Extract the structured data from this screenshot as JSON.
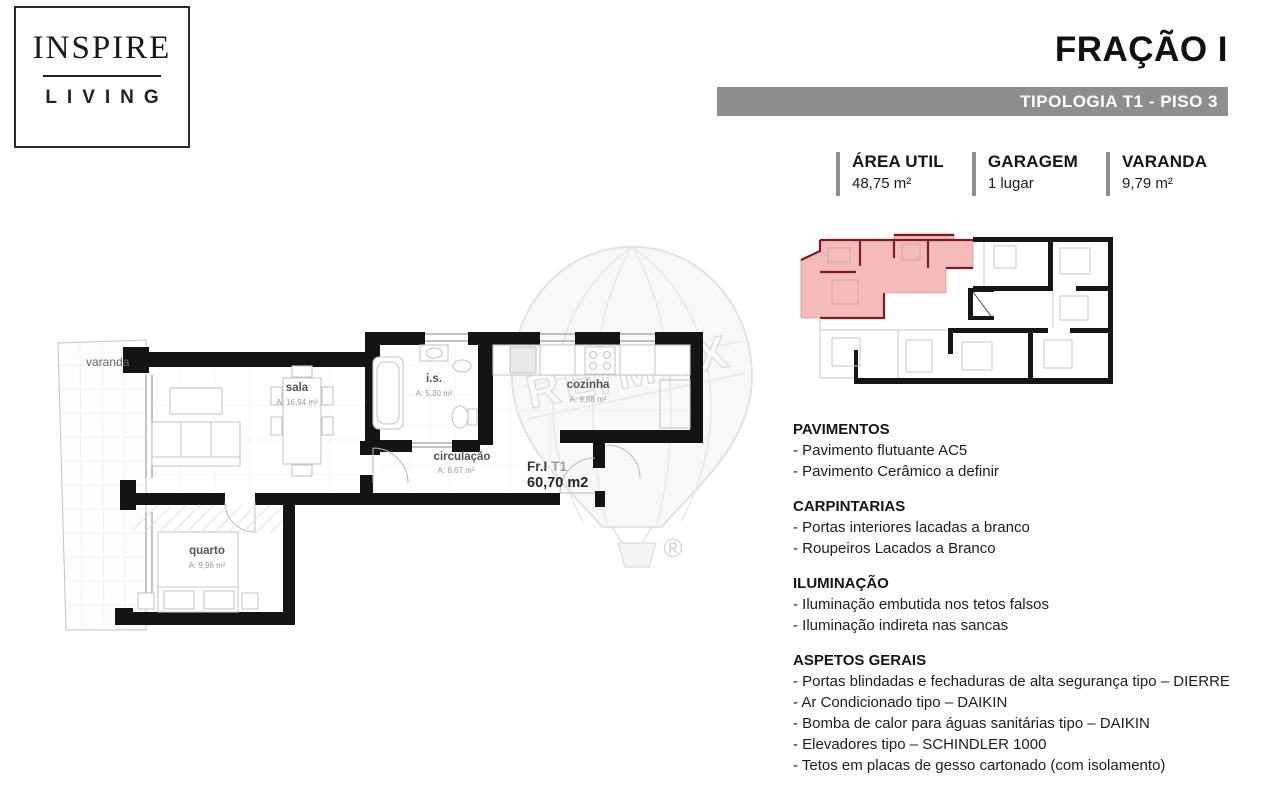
{
  "logo": {
    "line1": "INSPIRE",
    "line2": "LIVING"
  },
  "header": {
    "title": "FRAÇÃO I",
    "subtitle": "TIPOLOGIA T1 -  PISO 3"
  },
  "stats": [
    {
      "label": "ÁREA UTIL",
      "value": "48,75 m²"
    },
    {
      "label": "GARAGEM",
      "value": "1 lugar"
    },
    {
      "label": "VARANDA",
      "value": "9,79 m²"
    }
  ],
  "floorplan": {
    "unit_label": "Fr.I",
    "unit_type": "T1",
    "unit_area": "60,70 m2",
    "rooms": [
      {
        "name": "varanda",
        "area": ""
      },
      {
        "name": "sala",
        "area": "A: 16,94 m²"
      },
      {
        "name": "i.s.",
        "area": "A: 5,30 m²"
      },
      {
        "name": "cozinha",
        "area": "A: 9,88 m²"
      },
      {
        "name": "circulação",
        "area": "A: 6,67 m²"
      },
      {
        "name": "quarto",
        "area": "A: 9,96 m²"
      }
    ]
  },
  "watermark": {
    "brand": "RE/MAX",
    "registered": "®"
  },
  "sections": [
    {
      "title": "PAVIMENTOS",
      "items": [
        "- Pavimento flutuante AC5",
        "- Pavimento Cerâmico a definir"
      ]
    },
    {
      "title": "CARPINTARIAS",
      "items": [
        "- Portas interiores lacadas a branco",
        "- Roupeiros Lacados a Branco"
      ]
    },
    {
      "title": "ILUMINAÇÃO",
      "items": [
        "- Iluminação embutida nos tetos falsos",
        "- Iluminação indireta nas sancas"
      ]
    },
    {
      "title": "ASPETOS GERAIS",
      "items": [
        "- Portas blindadas e fechaduras de alta segurança tipo – DIERRE",
        "- Ar Condicionado tipo – DAIKIN",
        "- Bomba de calor para águas sanitárias tipo – DAIKIN",
        "- Elevadores tipo – SCHINDLER 1000",
        "- Tetos em placas de gesso cartonado (com isolamento)"
      ]
    }
  ],
  "colors": {
    "bar_gray": "#8e8e8e",
    "highlight_pink": "#f5baba",
    "wall_black": "#141414",
    "wall_red": "#7a1f1f"
  }
}
